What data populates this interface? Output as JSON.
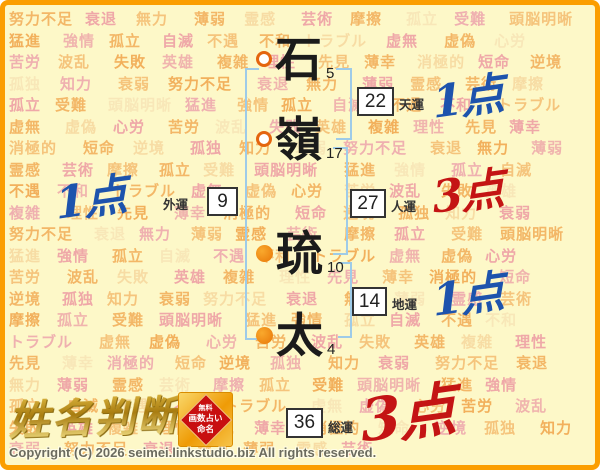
{
  "page": {
    "bg_color": "#fdf8c8",
    "border_color": "#fb9e01",
    "background_words": [
      "努力不足",
      "衰退",
      "無力",
      "薄弱",
      "霊感",
      "芸術",
      "摩擦",
      "孤立",
      "受難",
      "頭脳明晰",
      "猛進",
      "強情",
      "孤立",
      "自滅",
      "不遇",
      "不和",
      "トラブル",
      "虚無",
      "虚偽",
      "心労",
      "苦労",
      "波乱",
      "失敗",
      "英雄",
      "複雑",
      "理性",
      "先見",
      "薄幸",
      "消極的",
      "短命",
      "逆境",
      "孤独",
      "知力",
      "衰弱"
    ],
    "watermark_palette": [
      "#f3b767",
      "#efa8a8",
      "#f5c47c",
      "#f3b767",
      "#f7dca4",
      "#efa8a8",
      "#f3b767",
      "#f8e7b8",
      "#efb0b0",
      "#f5c47c",
      "#f2b05c",
      "#f0b4ae"
    ]
  },
  "name_chart": {
    "characters": [
      {
        "char": "石",
        "strokes": "5",
        "marker": "hollow"
      },
      {
        "char": "嶺",
        "strokes": "17",
        "marker": "hollow"
      },
      {
        "char": "琉",
        "strokes": "10",
        "marker": "filled"
      },
      {
        "char": "太",
        "strokes": "4",
        "marker": "filled"
      }
    ],
    "fortunes": [
      {
        "name": "天運",
        "value": "22",
        "score": "1点",
        "score_color": "blue"
      },
      {
        "name": "人運",
        "value": "27",
        "score": "3点",
        "score_color": "red"
      },
      {
        "name": "地運",
        "value": "14",
        "score": "1点",
        "score_color": "blue"
      },
      {
        "name": "外運",
        "value": "9",
        "score": "1点",
        "score_color": "blue"
      },
      {
        "name": "総運",
        "value": "36",
        "score": "3点",
        "score_color": "red"
      }
    ],
    "score_colors": {
      "blue": "#1d53ad",
      "red": "#c41414"
    }
  },
  "footer": {
    "logo_text": "姓名判断",
    "badge": {
      "line1": "無料",
      "line2": "画数占い",
      "line3": "命名"
    },
    "copyright": "Copyright (C) 2026 seimei.linkstudio.biz All rights reserved."
  }
}
